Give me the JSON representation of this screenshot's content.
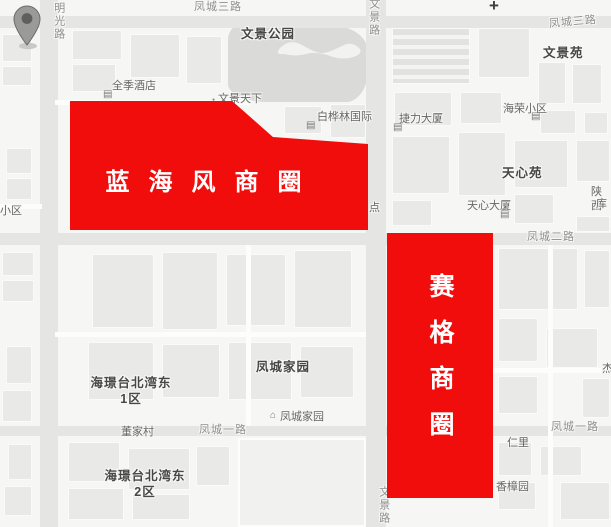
{
  "map": {
    "plus_sign": "+",
    "marker": {
      "name": "location-pin"
    },
    "labels": [
      {
        "id": "road-mingguang",
        "text": "明光路",
        "type": "road-v",
        "x": 51,
        "y": 2
      },
      {
        "id": "road-fengcheng-3-left",
        "text": "凤城三路",
        "type": "road-h",
        "x": 194,
        "y": 1
      },
      {
        "id": "road-wenjing-top",
        "text": "文景路",
        "type": "road-v",
        "x": 366,
        "y": -2
      },
      {
        "id": "road-fengcheng-3-right",
        "text": "凤城三路",
        "type": "road-h",
        "x": 549,
        "y": 16
      },
      {
        "id": "park-wenjing-gongyuan",
        "text": "文景公园",
        "type": "place-bold",
        "x": 241,
        "y": 27
      },
      {
        "id": "wenjingyuan",
        "text": "文景苑",
        "type": "place-bold",
        "x": 543,
        "y": 46
      },
      {
        "id": "quanji-hotel",
        "text": "全季酒店",
        "type": "place",
        "x": 112,
        "y": 80
      },
      {
        "id": "wenjing-tianxia",
        "text": "文景天下",
        "type": "place",
        "x": 218,
        "y": 93
      },
      {
        "id": "baihualin-guoji",
        "text": "白桦林国际",
        "type": "place",
        "x": 317,
        "y": 111
      },
      {
        "id": "jieli-dasha",
        "text": "捷力大厦",
        "type": "place",
        "x": 399,
        "y": 113
      },
      {
        "id": "hairong-xiaoqu",
        "text": "海荣小区",
        "type": "place",
        "x": 503,
        "y": 103
      },
      {
        "id": "tianxinyuan",
        "text": "天心苑",
        "type": "place-bold",
        "x": 502,
        "y": 166
      },
      {
        "id": "tianxin-dasha",
        "text": "天心大厦",
        "type": "place",
        "x": 467,
        "y": 200
      },
      {
        "id": "shaanxi-partial",
        "text": "陕西",
        "type": "place",
        "x": 591,
        "y": 186
      },
      {
        "id": "ku-partial",
        "text": "库",
        "type": "place",
        "x": 596,
        "y": 198
      },
      {
        "id": "dian-partial",
        "text": "点",
        "type": "place",
        "x": 369,
        "y": 202
      },
      {
        "id": "xiaoqu-partial",
        "text": "小区",
        "type": "place",
        "x": 0,
        "y": 205
      },
      {
        "id": "road-fengcheng-2",
        "text": "凤城二路",
        "type": "road-h",
        "x": 527,
        "y": 231
      },
      {
        "id": "fengcheng-jiayuan-bold",
        "text": "凤城家园",
        "type": "place-bold",
        "x": 256,
        "y": 360
      },
      {
        "id": "haijing-dong-1",
        "text": "海璟台北湾东\n1区",
        "type": "place-bold-center",
        "x": 131,
        "y": 376
      },
      {
        "id": "fengcheng-jiayuan-poi",
        "text": "凤城家园",
        "type": "place",
        "x": 280,
        "y": 411
      },
      {
        "id": "dongjiacun",
        "text": "董家村",
        "type": "place",
        "x": 121,
        "y": 426
      },
      {
        "id": "road-fengcheng-1-left",
        "text": "凤城一路",
        "type": "road-h",
        "x": 199,
        "y": 424
      },
      {
        "id": "road-fengcheng-1-right",
        "text": "凤城一路",
        "type": "road-h",
        "x": 551,
        "y": 421
      },
      {
        "id": "renli",
        "text": "仁里",
        "type": "place",
        "x": 507,
        "y": 437
      },
      {
        "id": "haijing-dong-2",
        "text": "海璟台北湾东\n2区",
        "type": "place-bold-center",
        "x": 145,
        "y": 469
      },
      {
        "id": "xiangzhangyuan",
        "text": "香樟园",
        "type": "place",
        "x": 496,
        "y": 481
      },
      {
        "id": "road-wenjing-bottom",
        "text": "文景路",
        "type": "road-v",
        "x": 376,
        "y": 486
      },
      {
        "id": "edge-partial",
        "text": "杰",
        "type": "place",
        "x": 602,
        "y": 363
      }
    ],
    "icons": [
      {
        "glyph": "building",
        "x": 103,
        "y": 90
      },
      {
        "glyph": "dot",
        "x": 212,
        "y": 98
      },
      {
        "glyph": "building",
        "x": 306,
        "y": 121
      },
      {
        "glyph": "building",
        "x": 393,
        "y": 123
      },
      {
        "glyph": "building",
        "x": 531,
        "y": 112
      },
      {
        "glyph": "building",
        "x": 500,
        "y": 210
      },
      {
        "glyph": "house",
        "x": 270,
        "y": 411
      }
    ]
  },
  "overlays": [
    {
      "id": "lanhaifeng",
      "label": "蓝海风商圈",
      "orientation": "horizontal",
      "color": "#f20d0d"
    },
    {
      "id": "saige",
      "label": "赛格商圈",
      "orientation": "vertical",
      "color": "#f20d0d"
    }
  ],
  "colors": {
    "overlay_red": "#f20d0d",
    "background": "#f6f6f5",
    "park_fill": "#dadad9",
    "road_fill": "#e5e5e4",
    "road_label": "#8f8f8f",
    "place_label": "#666665",
    "bold_label": "#474746"
  }
}
